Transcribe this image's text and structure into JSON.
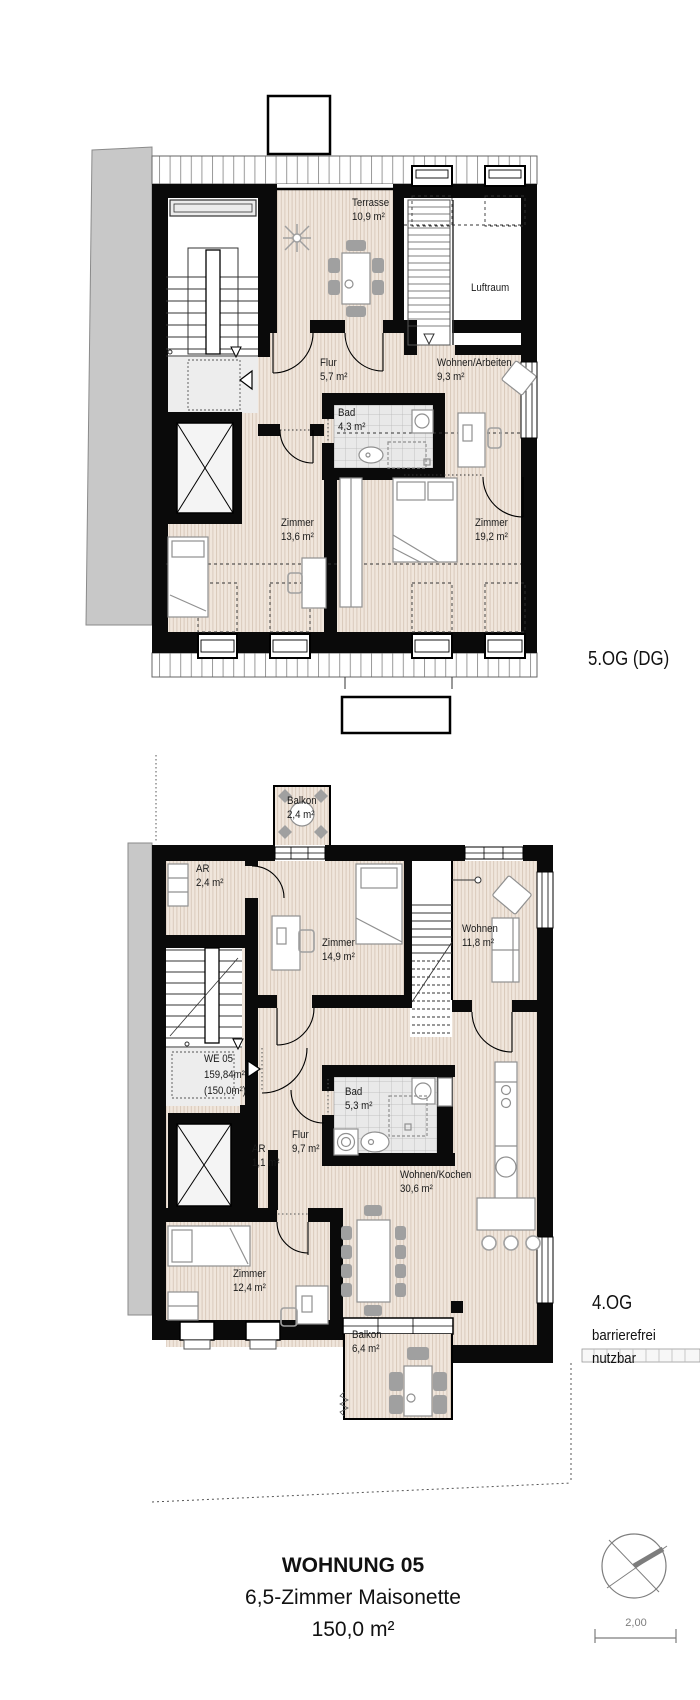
{
  "floors": {
    "upper": {
      "label": "5.OG (DG)",
      "rooms": {
        "terrasse": {
          "name": "Terrasse",
          "area": "10,9 m²"
        },
        "luftraum": {
          "name": "Luftraum",
          "area": ""
        },
        "flur": {
          "name": "Flur",
          "area": "5,7 m²"
        },
        "wohnen_arbeiten": {
          "name": "Wohnen/Arbeiten",
          "area": "9,3 m²"
        },
        "bad": {
          "name": "Bad",
          "area": "4,3 m²"
        },
        "zimmer1": {
          "name": "Zimmer",
          "area": "13,6 m²"
        },
        "zimmer2": {
          "name": "Zimmer",
          "area": "19,2 m²"
        }
      }
    },
    "lower": {
      "label": "4.OG",
      "note_line1": "barrierefrei",
      "note_line2": "nutzbar",
      "unit": {
        "id": "WE 05",
        "area_gross": "159,84m²",
        "area_net": "(150,0m²)"
      },
      "rooms": {
        "balkon_nord": {
          "name": "Balkon",
          "area": "2,4 m²"
        },
        "ar_gross": {
          "name": "AR",
          "area": "2,4 m²"
        },
        "zimmer1": {
          "name": "Zimmer",
          "area": "14,9 m²"
        },
        "wohnen": {
          "name": "Wohnen",
          "area": "11,8 m²"
        },
        "bad": {
          "name": "Bad",
          "area": "5,3 m²"
        },
        "flur": {
          "name": "Flur",
          "area": "9,7 m²"
        },
        "ar_klein": {
          "name": "AR",
          "area": "1,1 m²"
        },
        "wohnen_kochen": {
          "name": "Wohnen/Kochen",
          "area": "30,6 m²"
        },
        "zimmer2": {
          "name": "Zimmer",
          "area": "12,4 m²"
        },
        "balkon_sued": {
          "name": "Balkon",
          "area": "6,4 m²"
        }
      }
    }
  },
  "title_block": {
    "title": "WOHNUNG 05",
    "subtitle": "6,5-Zimmer Maisonette",
    "area": "150,0 m²"
  },
  "scale_bar": {
    "value": "2,00"
  },
  "icons": {
    "north_arrow": "north-arrow-icon",
    "entry_arrow": "entry-arrow-icon"
  },
  "colors": {
    "wall": "#0a0a0a",
    "floor_wood": "#f0e6dc",
    "floor_line": "#d7c7b8",
    "tile_bg": "#e9e9e9",
    "neighbor": "#c8c8c8",
    "drawing_grey": "#7d7d7d"
  }
}
